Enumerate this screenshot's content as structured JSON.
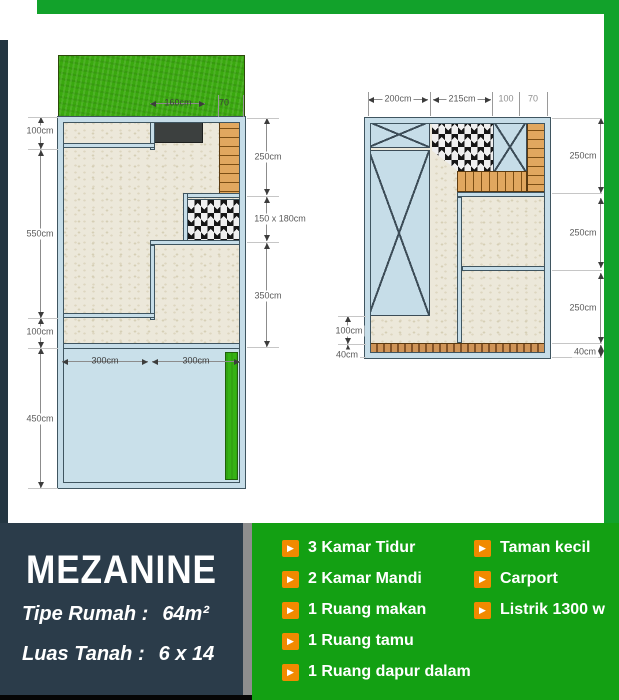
{
  "left_plan": {
    "dim_100_top": "100cm",
    "dim_550": "550cm",
    "dim_100_bottom": "100cm",
    "dim_450": "450cm",
    "dim_250": "250cm",
    "dim_bath": "150 x 180cm",
    "dim_350": "350cm",
    "dim_160": "160cm",
    "dim_70": "70",
    "dim_300_a": "300cm",
    "dim_300_b": "300cm"
  },
  "right_plan": {
    "dim_200": "200cm",
    "dim_215": "215cm",
    "dim_100_top": "100",
    "dim_70": "70",
    "dim_250_a": "250cm",
    "dim_250_b": "250cm",
    "dim_250_c": "250cm",
    "dim_40_right": "40cm",
    "dim_100_left": "100cm",
    "dim_40_left": "40cm"
  },
  "info": {
    "title": "MEZANINE",
    "tipe_label": "Tipe Rumah :",
    "tipe_value": "64m²",
    "luas_label": "Luas Tanah :",
    "luas_value": "6 x 14"
  },
  "features": {
    "col1": [
      "3 Kamar Tidur",
      "2 Kamar Mandi",
      "1 Ruang makan",
      "1 Ruang tamu",
      "1 Ruang dapur dalam"
    ],
    "col2": [
      "Taman kecil",
      "Carport",
      "Listrik 1300 w"
    ]
  },
  "icons": {
    "bullet": "▶"
  },
  "colors": {
    "accent_green": "#13a013",
    "frame_green": "#12a22b",
    "panel_dark": "#2b3c4a",
    "bullet_orange": "#f18a00",
    "wall_blue": "#c6dde8",
    "wood": "#e1a75f"
  }
}
